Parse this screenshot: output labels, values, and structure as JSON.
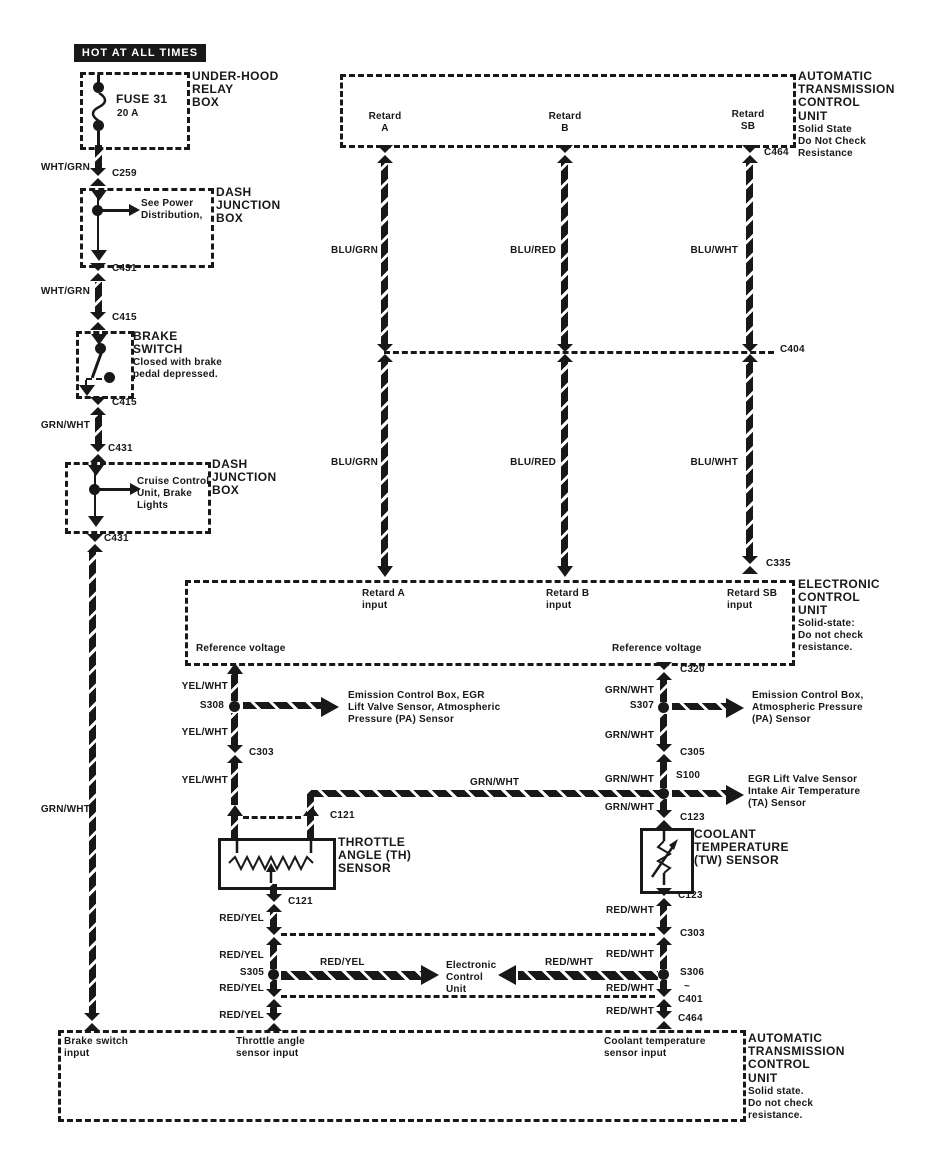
{
  "title_banner": "HOT AT ALL TIMES",
  "colors": {
    "ink": "#181818",
    "paper": "#ffffff"
  },
  "wire_colors": {
    "wht_grn": "WHT/GRN",
    "grn_wht": "GRN/WHT",
    "yel_wht": "YEL/WHT",
    "blu_grn": "BLU/GRN",
    "blu_red": "BLU/RED",
    "blu_wht": "BLU/WHT",
    "red_yel": "RED/YEL",
    "red_wht": "RED/WHT"
  },
  "connectors": {
    "c259": "C259",
    "c431": "C431",
    "c415": "C415",
    "c404": "C404",
    "c464": "C464",
    "c335": "C335",
    "c320": "C320",
    "c303": "C303",
    "c305": "C305",
    "c121": "C121",
    "c123": "C123",
    "c401": "C401",
    "c401_tilde": "~",
    "s308": "S308",
    "s307": "S307",
    "s100": "S100",
    "s305": "S305",
    "s306": "S306"
  },
  "power_chain": {
    "relay_box_label": "UNDER-HOOD\nRELAY\nBOX",
    "fuse_name": "FUSE 31",
    "fuse_rating": "20 A",
    "djb_label": "DASH\nJUNCTION\nBOX",
    "see_power": "See Power\nDistribution,",
    "brake_switch_title": "BRAKE\nSWITCH",
    "brake_switch_note": "Closed with brake\npedal depressed.",
    "cruise_note": "Cruise Control\nUnit, Brake\nLights"
  },
  "atcu_top": {
    "title": "AUTOMATIC\nTRANSMISSION\nCONTROL\nUNIT",
    "note": "Solid State\nDo Not Check\nResistance",
    "retard_a": "Retard\nA",
    "retard_b": "Retard\nB",
    "retard_sb": "Retard\nSB"
  },
  "ecu": {
    "title": "ELECTRONIC\nCONTROL\nUNIT",
    "note": "Solid-state:\nDo not check\nresistance.",
    "retard_a_input": "Retard A\ninput",
    "retard_b_input": "Retard B\ninput",
    "retard_sb_input": "Retard SB\ninput",
    "reference_voltage": "Reference voltage"
  },
  "sensors": {
    "th_title": "THROTTLE\nANGLE (TH)\nSENSOR",
    "tw_title": "COOLANT\nTEMPERATURE\n(TW) SENSOR",
    "s308_dest": "Emission Control Box, EGR\nLift Valve Sensor, Atmospheric\nPressure (PA) Sensor",
    "s307_dest": "Emission Control Box,\nAtmospheric Pressure\n(PA) Sensor",
    "s100_dest": "EGR Lift Valve Sensor\nIntake Air Temperature\n(TA) Sensor",
    "ecu_dest": "Electronic\nControl\nUnit"
  },
  "atcu_bottom": {
    "title": "AUTOMATIC\nTRANSMISSION\nCONTROL\nUNIT",
    "note": "Solid state.\nDo not check\nresistance.",
    "brake_input": "Brake switch\ninput",
    "throttle_input": "Throttle angle\nsensor input",
    "coolant_input": "Coolant temperature\nsensor input"
  }
}
